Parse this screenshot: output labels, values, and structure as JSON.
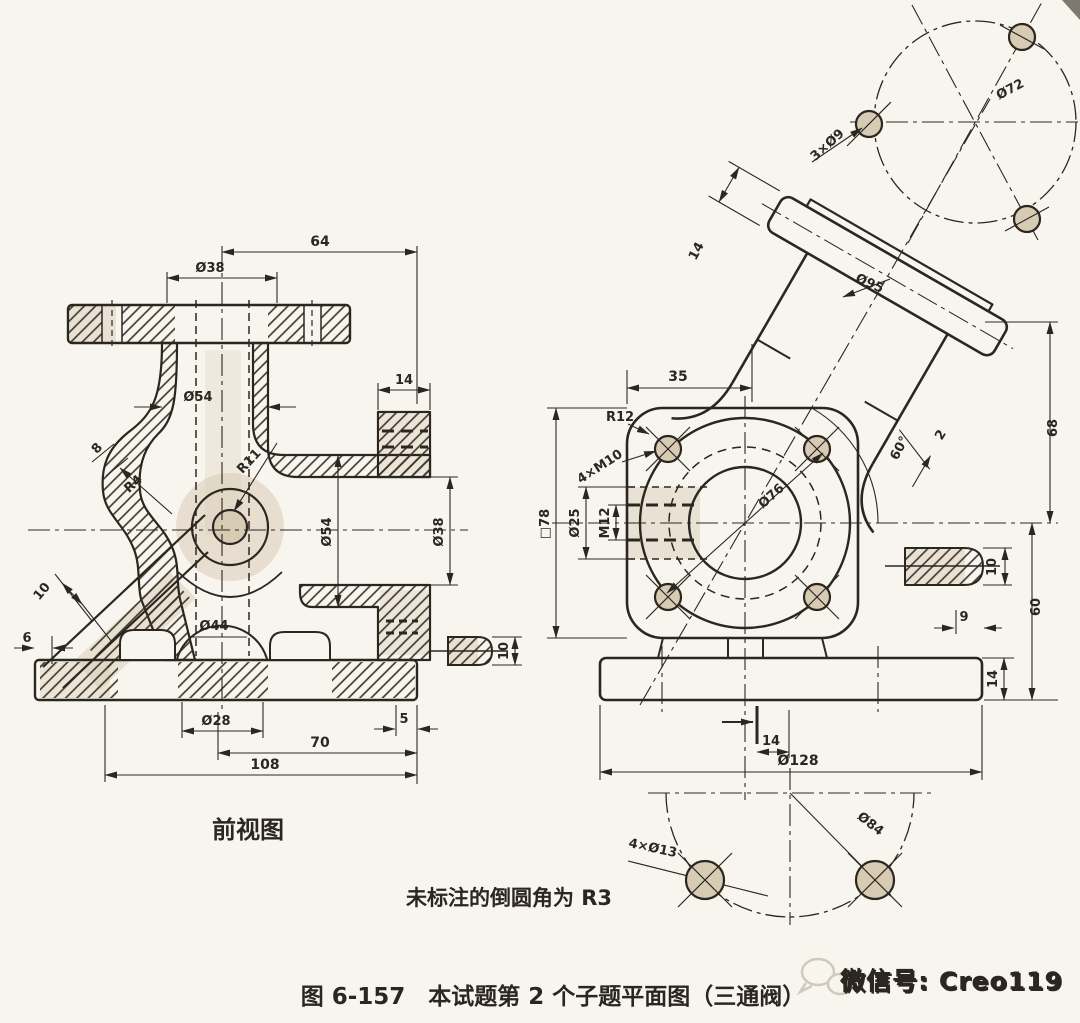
{
  "colors": {
    "paper": "#f8f5ef",
    "ink": "#2b2620",
    "tint": "#d8cbb4",
    "watermark": "#d9d3c7"
  },
  "front_view": {
    "label": "前视图",
    "dims": {
      "span64": "64",
      "bore38": "Ø38",
      "neck54": "Ø54",
      "flange14": "14",
      "r11": "R11",
      "r4": "R4",
      "wall8": "8",
      "rib10": "10",
      "rib6": "6",
      "bore44": "Ø44",
      "hub28": "Ø28",
      "step5": "5",
      "span70": "70",
      "span108": "108",
      "port54": "Ø54",
      "port38": "Ø38",
      "boss10": "10"
    }
  },
  "side_view": {
    "dims": {
      "flange14": "14",
      "flange95": "Ø95",
      "offset35": "35",
      "r12": "R12",
      "bolts": "4×M10",
      "square78": "□78",
      "port25": "Ø25",
      "thread12": "M12",
      "spigot76": "Ø76",
      "angle60": "60°",
      "step2": "2",
      "h68": "68",
      "rib10": "10",
      "h60": "60",
      "inset9": "9",
      "base14": "14",
      "offset14": "14",
      "base128": "Ø128"
    }
  },
  "top_detail": {
    "holes": "3×Ø9",
    "circle": "Ø72"
  },
  "bottom_detail": {
    "holes": "4×Ø13",
    "circle": "Ø84"
  },
  "notes": {
    "fillet_note": "未标注的倒圆角为 R3",
    "figure_caption": "图 6-157　本试题第 2 个子题平面图（三通阀）",
    "watermark": "微信号: Creo119"
  }
}
